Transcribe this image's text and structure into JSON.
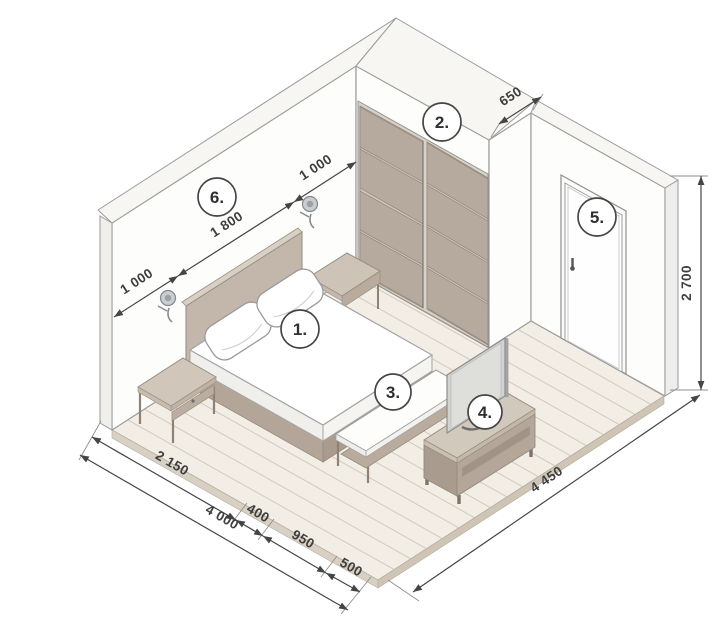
{
  "callouts": {
    "bed": "1.",
    "wardrobe": "2.",
    "bench": "3.",
    "tv": "4.",
    "door": "5.",
    "accent_wall": "6."
  },
  "dims": {
    "left_wall_segments": [
      "1 000",
      "1 800",
      "1 000"
    ],
    "niche_depth": "650",
    "room_height": "2 700",
    "front_segments": [
      "2 150",
      "400",
      "950",
      "500"
    ],
    "front_total": "4 000",
    "side_total": "4 450"
  },
  "colors": {
    "furniture_taupe": "#b5a89c",
    "floor": "#f2eee6",
    "dimension_line": "#454545"
  }
}
